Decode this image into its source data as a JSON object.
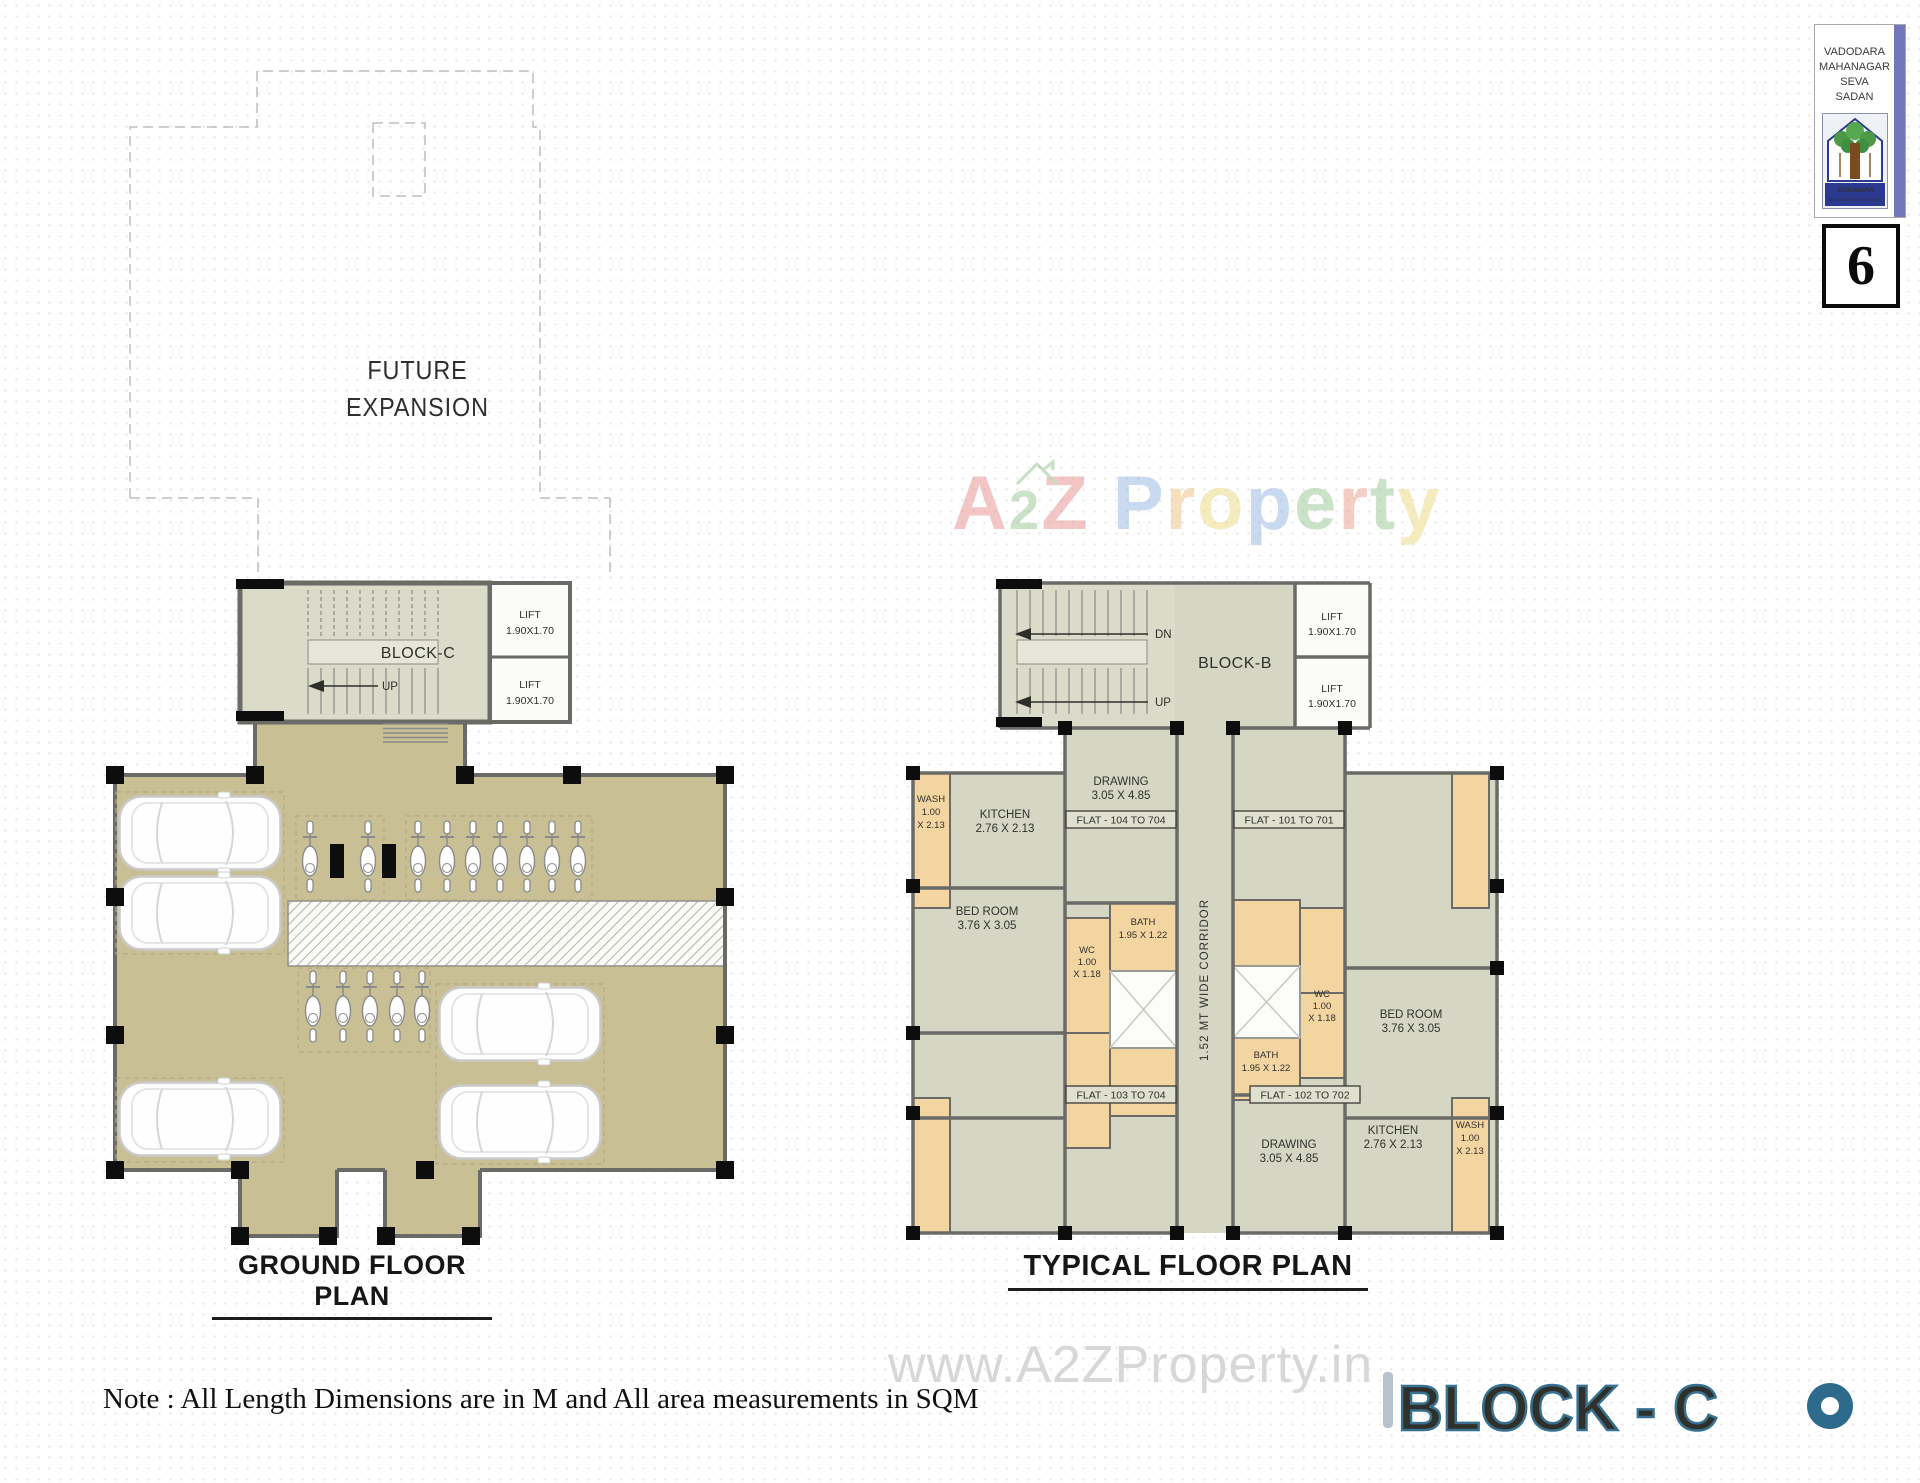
{
  "header": {
    "org": {
      "lines": [
        "VADODARA",
        "MAHANAGAR",
        "SEVA",
        "SADAN"
      ],
      "emblem_title": "VADODARA",
      "emblem_subtitle": "MAHANAGAR SEVA SADAN"
    },
    "page_number": "6"
  },
  "watermark": {
    "brand_letters": [
      {
        "ch": "A",
        "color": "#e88f8f"
      },
      {
        "ch": "2",
        "color": "#96c693"
      },
      {
        "ch": "Z",
        "color": "#e88f8f"
      },
      {
        "ch": " ",
        "color": ""
      },
      {
        "ch": "P",
        "color": "#92b4e3"
      },
      {
        "ch": "r",
        "color": "#eec17d"
      },
      {
        "ch": "o",
        "color": "#ead87f"
      },
      {
        "ch": "p",
        "color": "#92b4e3"
      },
      {
        "ch": "e",
        "color": "#96c693"
      },
      {
        "ch": "r",
        "color": "#eb9d8a"
      },
      {
        "ch": "t",
        "color": "#96c693"
      },
      {
        "ch": "y",
        "color": "#ead87f"
      }
    ],
    "site_url": "www.A2ZProperty.in"
  },
  "ground_plan": {
    "title": "GROUND FLOOR PLAN",
    "future_expansion_line1": "FUTURE",
    "future_expansion_line2": "EXPANSION",
    "block_label": "BLOCK-C",
    "up_label": "UP",
    "lift_label": "LIFT",
    "lift_size": "1.90X1.70"
  },
  "typical_plan": {
    "title": "TYPICAL FLOOR PLAN",
    "block_label": "BLOCK-B",
    "dn_label": "DN",
    "up_label": "UP",
    "lift_label": "LIFT",
    "lift_size": "1.90X1.70",
    "corridor_label": "1.52 MT WIDE CORRIDOR",
    "flats": {
      "f101": "FLAT - 101 TO 701",
      "f102": "FLAT - 102 TO 702",
      "f103": "FLAT - 103 TO 704",
      "f104": "FLAT - 104 TO 704"
    },
    "rooms": {
      "drawing_name": "DRAWING",
      "drawing_dim": "3.05 X 4.85",
      "kitchen_name": "KITCHEN",
      "kitchen_dim": "2.76 X 2.13",
      "bedroom_name": "BED ROOM",
      "bedroom_dim": "3.76 X 3.05",
      "wash_name": "WASH",
      "wash_dim1": "1.00",
      "wash_dim2": "X 2.13",
      "wc_name": "WC",
      "wc_dim1": "1.00",
      "wc_dim2": "X 1.18",
      "bath_name": "BATH",
      "bath_dim": "1.95 X 1.22"
    }
  },
  "footer": {
    "note": "Note : All Length Dimensions are in M and All area measurements in SQM",
    "sheet_title": "BLOCK - C"
  },
  "colors": {
    "parking_fill": "#c8c094",
    "room_fill": "#d5d7c4",
    "wet_room_fill": "#f3d5a1",
    "wall": "#6a6a66",
    "sheet_title_accent": "#38708f",
    "logo_stripe": "#7376ba",
    "emblem_navy": "#2b3990"
  }
}
